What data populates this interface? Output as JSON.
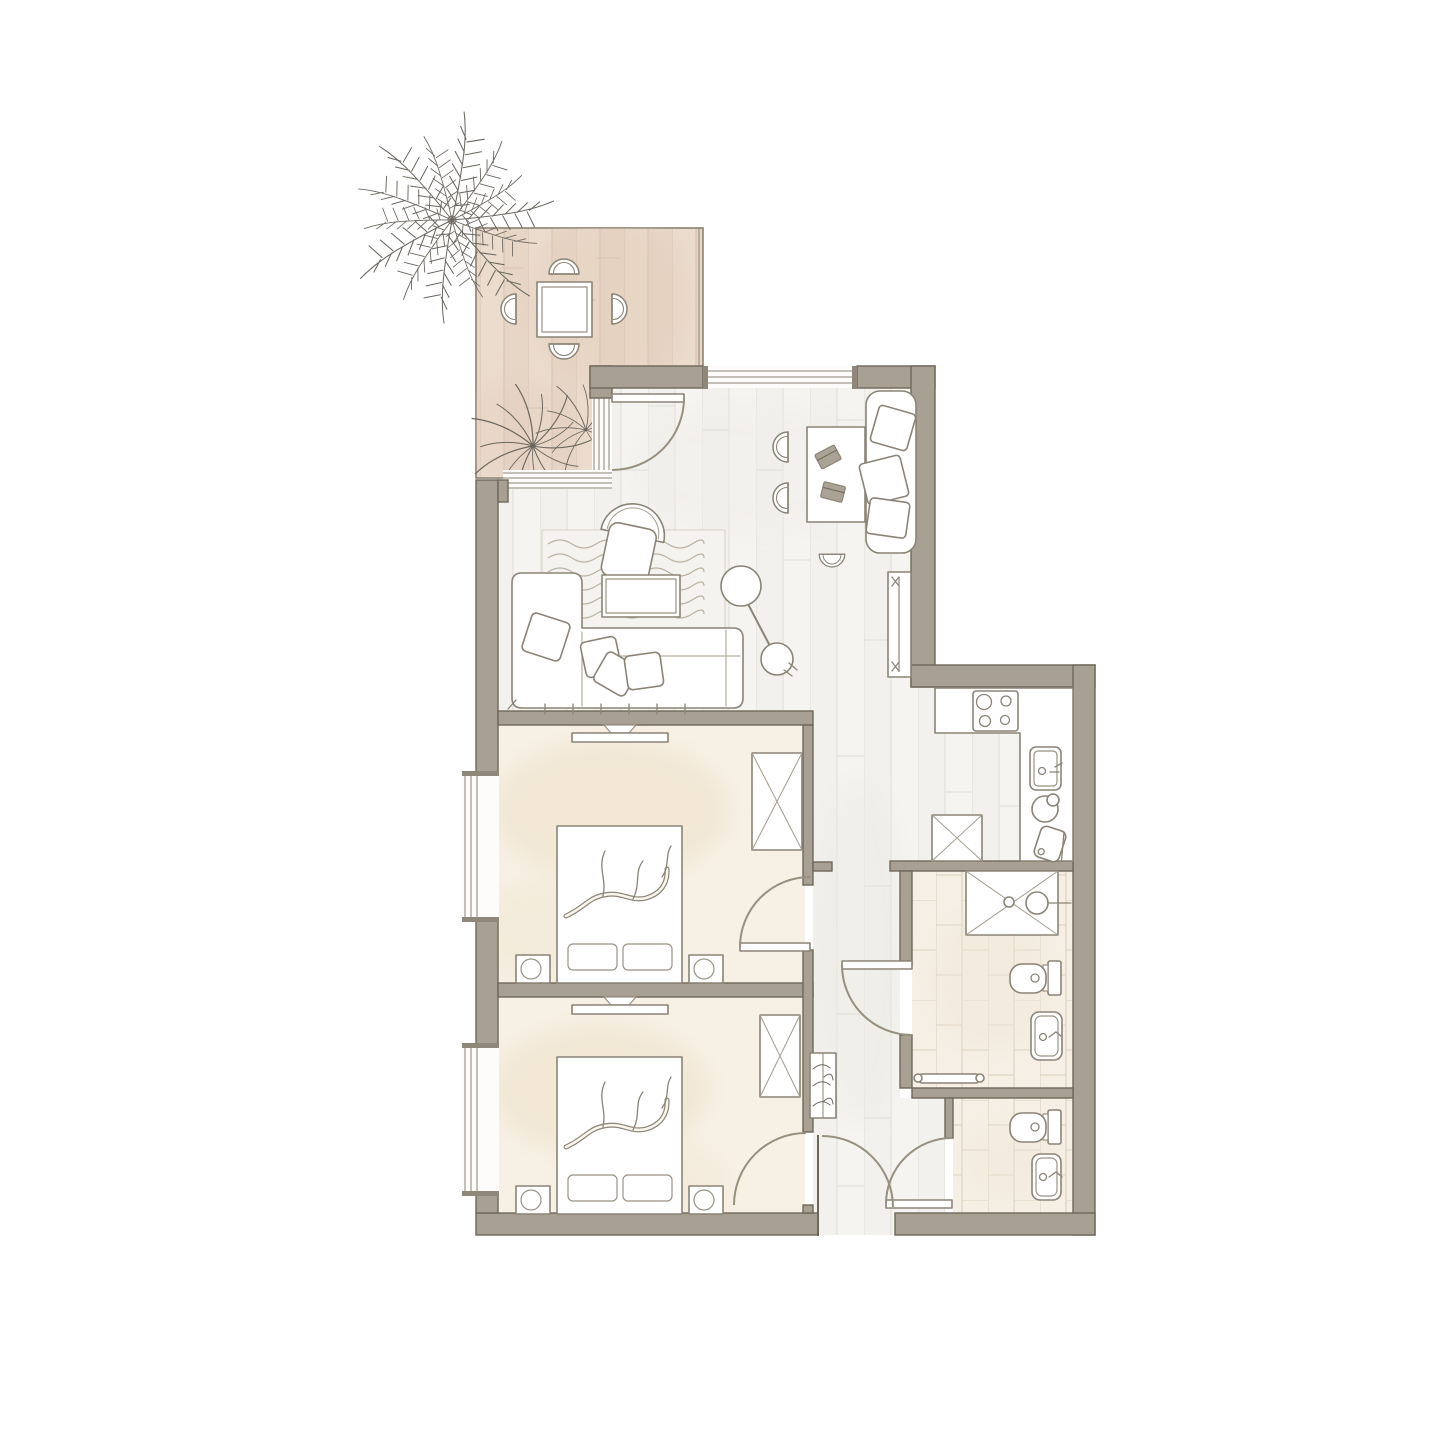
{
  "canvas": {
    "width": 1440,
    "height": 1440,
    "background": "#ffffff"
  },
  "colors": {
    "wall": "#a8a093",
    "wall_outline": "#6f685a",
    "wood_floor_a": "#f2f1ed",
    "wood_floor_b": "#f5f4f0",
    "wood_line": "#e3e1db",
    "terrace_floor_a": "#ebdccd",
    "terrace_floor_b": "#e7d6c6",
    "terrace_line": "#d8c2b2",
    "bedroom_floor": "#f7f0e4",
    "tile_floor": "#f6efe5",
    "tile_line": "#dccfbc",
    "furniture_fill": "#ffffff",
    "furniture_stroke": "#8b8476",
    "door_stroke": "#98907f",
    "plant_stroke": "#6b675f",
    "rug_line": "#bab1a2",
    "laptop_fill": "#aaa294"
  },
  "floorplan": {
    "type": "apartment-floor-plan",
    "rooms": [
      {
        "name": "terrace",
        "floor": "terrace-wood-planks",
        "features": [
          "palm-tree",
          "square-dining-table",
          "terrace-chair x4",
          "potted-agave x2",
          "glazed-wall"
        ]
      },
      {
        "name": "living-room",
        "floor": "wood-planks",
        "features": [
          "sofa",
          "sofa-pillow x4",
          "armchair",
          "coffee-table",
          "rug",
          "arc-floor-lamp",
          "desk",
          "desk-chair x2",
          "laptop x2",
          "stool",
          "lounge-chair",
          "lounge-pillow x3",
          "radiator",
          "top-window",
          "terrace-door"
        ]
      },
      {
        "name": "kitchen",
        "floor": "wood-planks",
        "features": [
          "l-shaped-counter",
          "cooktop-4-burners",
          "sink",
          "bowl",
          "cutting-board",
          "tall-cabinet-x-symbol"
        ]
      },
      {
        "name": "hallway",
        "floor": "wood-planks",
        "features": [
          "coat-rack",
          "entrance-door"
        ]
      },
      {
        "name": "bedroom-1",
        "floor": "cream-watercolor",
        "features": [
          "double-bed",
          "bed-pillow x2",
          "branch-blanket-motif",
          "nightstand-with-lamp x2",
          "wall-tv",
          "wardrobe-x-symbol",
          "window",
          "door"
        ]
      },
      {
        "name": "bedroom-2",
        "floor": "cream-watercolor",
        "features": [
          "double-bed",
          "bed-pillow x2",
          "branch-blanket-motif",
          "nightstand-with-lamp x2",
          "wall-tv",
          "wardrobe-x-symbol",
          "window",
          "door"
        ]
      },
      {
        "name": "bathroom",
        "floor": "beige-tiles",
        "features": [
          "shower-with-x-symbol",
          "shower-head",
          "wall-toilet",
          "washbasin",
          "towel-rail",
          "door"
        ]
      },
      {
        "name": "wc",
        "floor": "beige-tiles",
        "features": [
          "wall-toilet",
          "washbasin",
          "door"
        ]
      }
    ],
    "windows": [
      "living-room-top-window",
      "bedroom-1-left-window",
      "bedroom-2-left-window"
    ],
    "doors": [
      "terrace-door",
      "bedroom-1-door",
      "bedroom-2-door",
      "bathroom-door",
      "wc-door",
      "entrance-door"
    ]
  }
}
